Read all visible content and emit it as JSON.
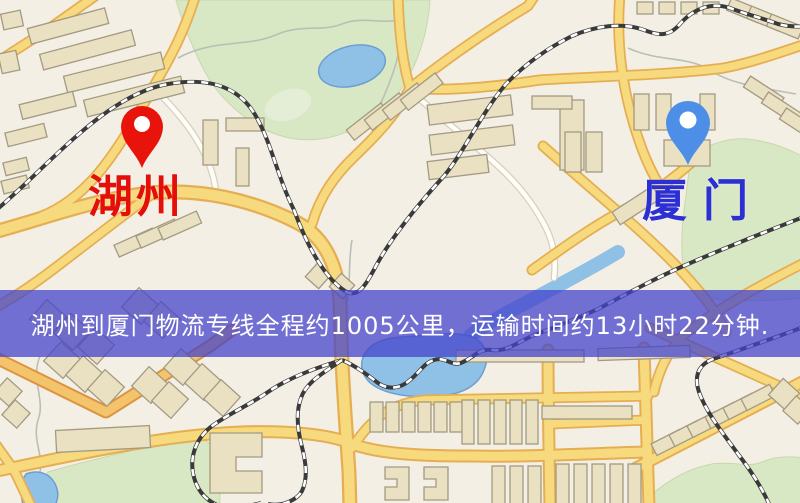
{
  "markers": {
    "origin": {
      "label": "湖州",
      "pin_color": "#e8140c",
      "label_color": "#e30f08"
    },
    "destination": {
      "label": "厦门",
      "pin_color": "#4d8ee6",
      "label_color": "#2b2fd4"
    }
  },
  "banner": {
    "text": "湖州到厦门物流专线全程约1005公里，运输时间约13小时22分钟.",
    "background_color": "rgba(67,66,202,0.74)",
    "text_color": "#ffffff"
  },
  "map_palette": {
    "background": "#f3efe5",
    "road_fill": "#f7da7e",
    "road_casing": "#e6ae52",
    "road_fill_orange": "#f4c46c",
    "road_casing_orange": "#dd9440",
    "minor_road_fill": "#fffdf8",
    "minor_road_casing": "#d8cfbe",
    "park": "#d9e8c4",
    "water": "#8fc0e6",
    "railway": "#3a3a3a",
    "building_fill": "#eae0c2",
    "building_stroke": "#a39a82"
  }
}
